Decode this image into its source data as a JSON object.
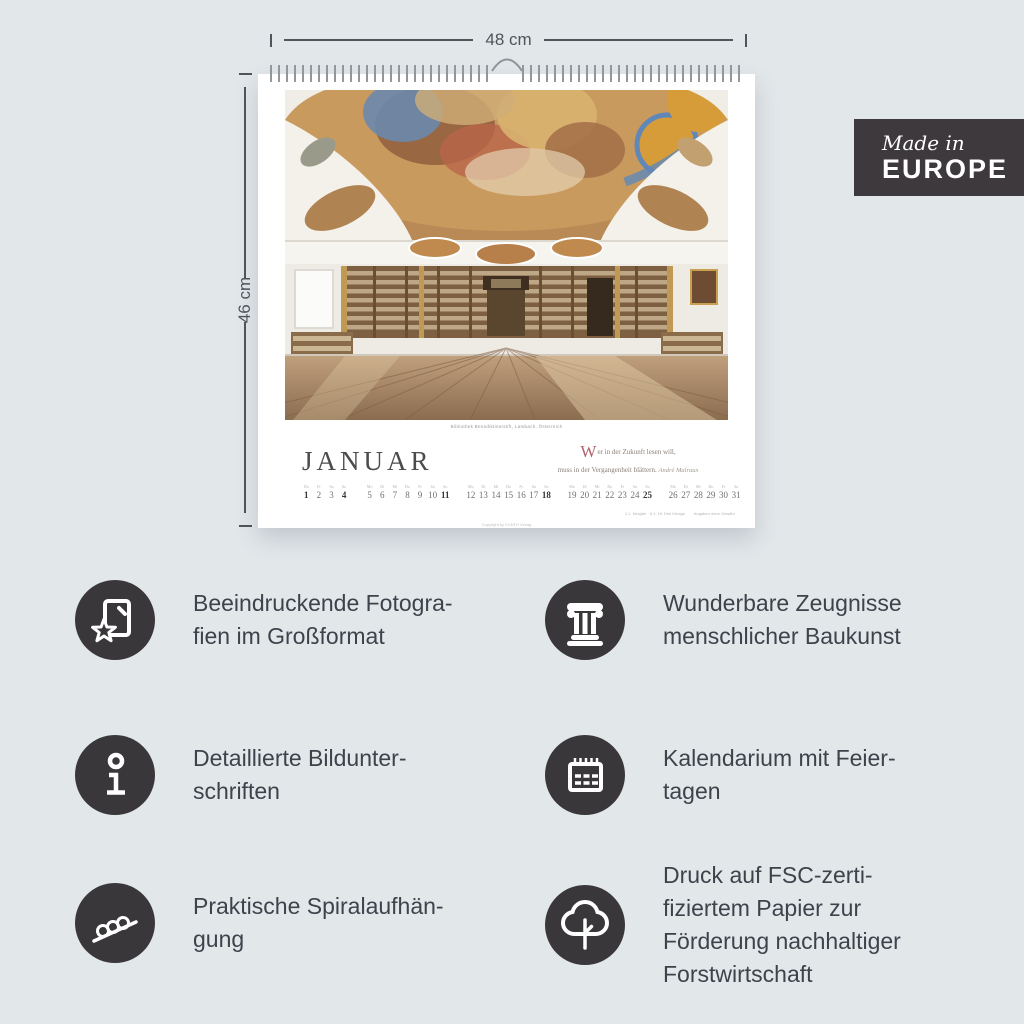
{
  "dimensions": {
    "width_label": "48 cm",
    "height_label": "46 cm"
  },
  "badge": {
    "line1": "Made in",
    "line2": "EUROPE"
  },
  "calendar": {
    "month": "JANUAR",
    "photo_caption": "Bibliothek Benediktinerstift, Lambach, Österreich",
    "quote": {
      "initial": "W",
      "line1": "er in der Zukunft lesen will,",
      "line2": "muss in der Vergangenheit blättern.",
      "attribution": "André Malraux"
    },
    "notes": {
      "holidays": "1.1. Neujahr · 6.1. Hl. Drei Könige",
      "disclaimer": "Angaben ohne Gewähr"
    },
    "copyright": "Copyright by KUNTH Verlag",
    "days": [
      {
        "n": "1",
        "w": "Do",
        "bold": true
      },
      {
        "n": "2",
        "w": "Fr",
        "bold": false
      },
      {
        "n": "3",
        "w": "Sa",
        "bold": false
      },
      {
        "n": "4",
        "w": "So",
        "bold": true
      },
      {
        "n": "5",
        "w": "Mo",
        "bold": false
      },
      {
        "n": "6",
        "w": "Di",
        "bold": false
      },
      {
        "n": "7",
        "w": "Mi",
        "bold": false
      },
      {
        "n": "8",
        "w": "Do",
        "bold": false
      },
      {
        "n": "9",
        "w": "Fr",
        "bold": false
      },
      {
        "n": "10",
        "w": "Sa",
        "bold": false
      },
      {
        "n": "11",
        "w": "So",
        "bold": true
      },
      {
        "n": "12",
        "w": "Mo",
        "bold": false
      },
      {
        "n": "13",
        "w": "Di",
        "bold": false
      },
      {
        "n": "14",
        "w": "Mi",
        "bold": false
      },
      {
        "n": "15",
        "w": "Do",
        "bold": false
      },
      {
        "n": "16",
        "w": "Fr",
        "bold": false
      },
      {
        "n": "17",
        "w": "Sa",
        "bold": false
      },
      {
        "n": "18",
        "w": "So",
        "bold": true
      },
      {
        "n": "19",
        "w": "Mo",
        "bold": false
      },
      {
        "n": "20",
        "w": "Di",
        "bold": false
      },
      {
        "n": "21",
        "w": "Mi",
        "bold": false
      },
      {
        "n": "22",
        "w": "Do",
        "bold": false
      },
      {
        "n": "23",
        "w": "Fr",
        "bold": false
      },
      {
        "n": "24",
        "w": "Sa",
        "bold": false
      },
      {
        "n": "25",
        "w": "So",
        "bold": true
      },
      {
        "n": "26",
        "w": "Mo",
        "bold": false
      },
      {
        "n": "27",
        "w": "Di",
        "bold": false
      },
      {
        "n": "28",
        "w": "Mi",
        "bold": false
      },
      {
        "n": "29",
        "w": "Do",
        "bold": false
      },
      {
        "n": "30",
        "w": "Fr",
        "bold": false
      },
      {
        "n": "31",
        "w": "Sa",
        "bold": false
      }
    ]
  },
  "features": [
    {
      "icon": "photo-star-icon",
      "text": "Beeindruckende Fotogra-\nfien im Großformat"
    },
    {
      "icon": "column-icon",
      "text": "Wunderbare Zeugnisse\nmenschlicher Baukunst"
    },
    {
      "icon": "info-icon",
      "text": "Detaillierte Bildunter-\nschriften"
    },
    {
      "icon": "calendar-icon",
      "text": "Kalendarium mit Feier-\ntagen"
    },
    {
      "icon": "spiral-icon",
      "text": "Praktische Spiralaufhän-\ngung"
    },
    {
      "icon": "tree-icon",
      "text": "Druck auf FSC-zerti-\nfiziertem Papier zur\nFörderung nachhaltiger\nForstwirtschaft"
    }
  ],
  "colors": {
    "background": "#e2e7ea",
    "badge_bg": "#3d393c",
    "icon_circle": "#3a373a",
    "feature_text": "#3d434b",
    "dimension": "#4e555b",
    "quote_initial": "#b2616b"
  }
}
